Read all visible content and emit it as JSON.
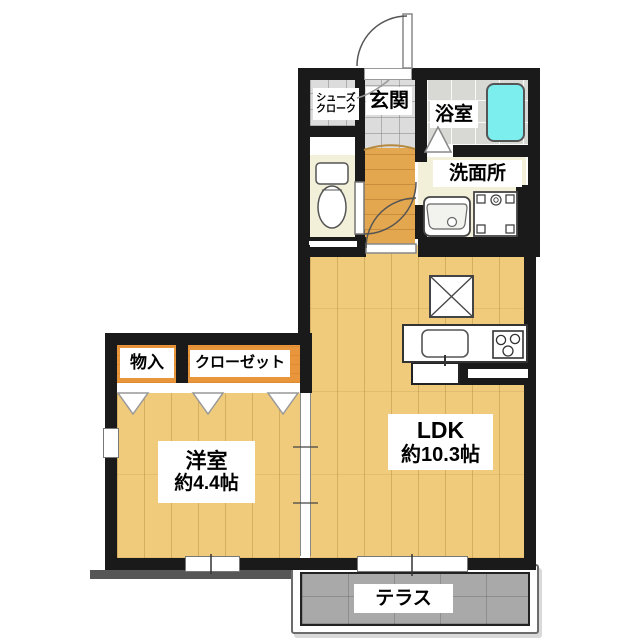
{
  "colors": {
    "wall": "#1a1a1a",
    "wood_floor": "#f0cb7c",
    "hall_floor": "#e3a74f",
    "closet_orange": "#e8953c",
    "bathtub_cyan": "#7deeee",
    "entry_tile_gray": "#dcdcdc",
    "bath_tile_gray": "#d8d8d4",
    "sanitary_cream": "#f3f0da",
    "terrace_gray": "#a9a9a9"
  },
  "rooms": {
    "shoes_cloak": {
      "line1": "シューズ",
      "line2": "クローク"
    },
    "entrance": {
      "label": "玄関"
    },
    "bathroom": {
      "label": "浴室"
    },
    "washroom": {
      "label": "洗面所"
    },
    "storage": {
      "label": "物入"
    },
    "closet": {
      "label": "クローゼット"
    },
    "western_room": {
      "label": "洋室",
      "size": "約4.4帖"
    },
    "ldk": {
      "label": "LDK",
      "size": "約10.3帖"
    },
    "terrace": {
      "label": "テラス"
    }
  }
}
